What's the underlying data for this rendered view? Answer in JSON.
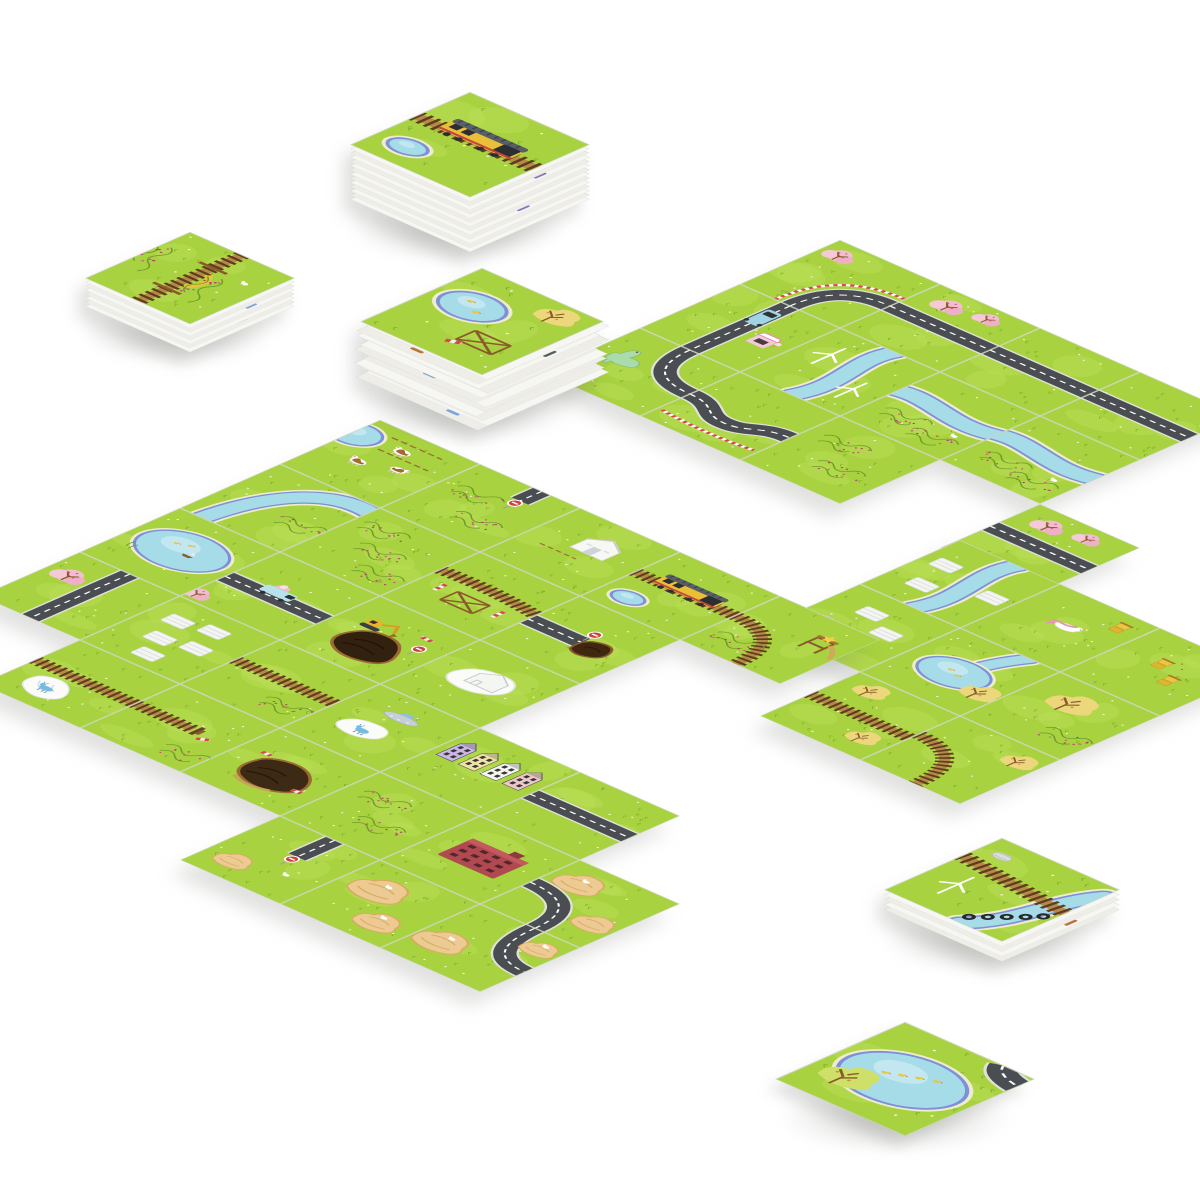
{
  "scene": {
    "background": "#ffffff",
    "description": "Photo-style overhead scene of an illustrated tile-laying board game: stacks of square landscape cards and three clusters of laid-out tiles connected by roads, railway tracks and rivers on a white table."
  },
  "palette": {
    "grass": "#a8d23f",
    "grass_light": "#b9dd55",
    "grass_dark": "#77aa28",
    "road": "#4a4e52",
    "road_edge": "#dfe3d5",
    "road_dash": "#ffffff",
    "water": "#a6dbe8",
    "water_deep": "#7e90d8",
    "shore": "#efeccb",
    "rail_tie": "#5f3d1b",
    "rail_wood": "#b5894a",
    "wood_dark": "#8a5a2b",
    "blossom": "#f2bdcf",
    "blossom_dot": "#d25d7e",
    "autumn": "#ecd77c",
    "canyon": "#ecca92",
    "canyon_line": "#d8ab63",
    "brick": "#b04a50",
    "train_yellow": "#e9bf37",
    "barrier_red": "#d84848",
    "card_side": "#f3f3ef",
    "card_edge": "#d8d8d2"
  },
  "geometry": {
    "tile_diamond_width": 200,
    "tile_diamond_height": 88,
    "col_step": {
      "x": 100,
      "y": 44
    },
    "row_step": {
      "x": -100,
      "y": 44
    }
  },
  "tile_types": {
    "grass_plain": "plain green meadow",
    "road_straight": "straight road with white dashes",
    "road_pink": "road with pink cherry-blossom trees",
    "road_curve_guard": "curved road with red-white guardrail and blossom tree",
    "road_s_guard": "S-shaped road with striped guardrail",
    "road_dino": "curved road with pale green dinosaur",
    "road_truck": "road with blue ice-cream truck",
    "roadend_tunnel": "dead-end road, no-entry sign and dark dirt mound",
    "roadend_dirt": "dead-end road with no-entry sign and goat",
    "canyon_road": "road curving between tan canyon mesas",
    "canyon_road2": "road bend through canyon rocks",
    "canyon_rocks": "tan mesa rocks with white goats",
    "rail_straight": "straight railway track",
    "rail_train": "railway with yellow diesel locomotive and pond",
    "rail_trees": "railway with yellow autumn trees",
    "rail_curve_r": "railway curving toward tile edge",
    "rail_waterfall": "railway beside white waterfall patch and blue alien cow",
    "rail_buffer": "railway ending at wooden buffer with striped barrier",
    "rail_bridge_berry": "vertical wooden rail bridge with yellow arch among berry fields",
    "rail_diag_river": "railway crossing with river, black tires and turbine outline",
    "trestle_rail": "railway on wooden trestle with red-white barriers",
    "river_meadow": "river bending through meadow",
    "river_windmill": "river with white wind turbines",
    "river_berry": "river beside wild berry scrub",
    "river_pond_tree": "river widening into pond with ducks and autumn tree",
    "pond_boats": "large pond with sailboat and ducks",
    "pond_trestle": "pond with ducks, autumn tree and construction trestle",
    "cows_pond": "pasture with three brown-white cows and pond corner",
    "berry_meadow": "meadow with berry-bush rows",
    "berry_hill": "hillside rows of berry bushes",
    "berries_roadend": "berry field with short dead-end road stub",
    "barn_grass": "white barn on meadow",
    "plots_white": "white planted garden beds",
    "plots_river": "garden beds split by a river",
    "plots_hay": "garden beds with grey hay rolls",
    "grass_shop": "roadside stop with small bus and ice-cream kiosk",
    "grass_unicorn": "white unicorn with pink mane resting on grass",
    "beehive_grass": "yellow beehive boxes on meadow",
    "yellowtree_berry": "large autumn tree with berry scrub",
    "city_houses": "row of pastel gabled townhouses",
    "red_factory": "red brick factory building with dark windows",
    "snow_house": "white snowy patch with outlined house",
    "snow_ufo": "hovering UFO above snow patch with blue alien cow",
    "excavator_hole": "yellow excavator digging a dark pit, striped cones",
    "dirt_pile": "large dark soil heap with striped markers",
    "slide_berry": "wooden lookout tower with slide and gold star beside curving rail",
    "lake_ducks_road": "wide lake with duck family, green tree and road corner"
  },
  "clusters": [
    {
      "name": "tile-cluster-top-right",
      "origin": {
        "x": 840,
        "y": 240
      },
      "tiles": [
        {
          "r": 0,
          "c": 0,
          "type": "road_curve_guard"
        },
        {
          "r": 0,
          "c": 1,
          "type": "road_pink"
        },
        {
          "r": 0,
          "c": 2,
          "type": "road_straight"
        },
        {
          "r": 0,
          "c": 3,
          "type": "road_straight"
        },
        {
          "r": 1,
          "c": 0,
          "type": "grass_shop"
        },
        {
          "r": 1,
          "c": 1,
          "type": "river_windmill"
        },
        {
          "r": 1,
          "c": 2,
          "type": "river_berry"
        },
        {
          "r": 1,
          "c": 3,
          "type": "river_berry"
        },
        {
          "r": 2,
          "c": 0,
          "type": "road_dino"
        },
        {
          "r": 2,
          "c": 1,
          "type": "road_s_guard"
        },
        {
          "r": 2,
          "c": 2,
          "type": "berry_meadow"
        },
        {
          "r": 2,
          "c": 4,
          "type": "road_pink"
        }
      ]
    },
    {
      "name": "tile-cluster-right-river",
      "origin": {
        "x": 960,
        "y": 540
      },
      "tiles": [
        {
          "r": 0,
          "c": 0,
          "type": "plots_river"
        },
        {
          "r": 0,
          "c": 1,
          "type": "grass_unicorn"
        },
        {
          "r": 0,
          "c": 2,
          "type": "beehive_grass"
        },
        {
          "r": 1,
          "c": 0,
          "type": "plots_hay"
        },
        {
          "r": 1,
          "c": 1,
          "type": "river_pond_tree"
        },
        {
          "r": 1,
          "c": 2,
          "type": "yellowtree_berry"
        },
        {
          "r": 2,
          "c": 1,
          "type": "rail_trees"
        },
        {
          "r": 2,
          "c": 2,
          "type": "rail_curve_r"
        }
      ]
    },
    {
      "name": "tile-cluster-central",
      "origin": {
        "x": 380,
        "y": 420
      },
      "tiles": [
        {
          "r": 0,
          "c": 0,
          "type": "cows_pond"
        },
        {
          "r": 0,
          "c": 1,
          "type": "berries_roadend"
        },
        {
          "r": 0,
          "c": 2,
          "type": "barn_grass"
        },
        {
          "r": 0,
          "c": 3,
          "type": "rail_train"
        },
        {
          "r": 0,
          "c": 4,
          "type": "slide_berry"
        },
        {
          "r": 1,
          "c": 0,
          "type": "river_meadow"
        },
        {
          "r": 1,
          "c": 1,
          "type": "berry_hill"
        },
        {
          "r": 1,
          "c": 2,
          "type": "trestle_rail"
        },
        {
          "r": 1,
          "c": 3,
          "type": "roadend_tunnel"
        },
        {
          "r": 2,
          "c": 0,
          "type": "pond_boats"
        },
        {
          "r": 2,
          "c": 1,
          "type": "road_truck"
        },
        {
          "r": 2,
          "c": 2,
          "type": "excavator_hole"
        },
        {
          "r": 2,
          "c": 3,
          "type": "snow_house"
        },
        {
          "r": 3,
          "c": 0,
          "type": "pink_road"
        },
        {
          "r": 3,
          "c": 1,
          "type": "plots_white"
        },
        {
          "r": 3,
          "c": 2,
          "type": "rail_straight"
        },
        {
          "r": 3,
          "c": 3,
          "type": "snow_ufo"
        },
        {
          "r": 3,
          "c": 4,
          "type": "city_houses"
        },
        {
          "r": 3,
          "c": 5,
          "type": "road_straight"
        },
        {
          "r": 4,
          "c": 1,
          "type": "rail_waterfall"
        },
        {
          "r": 4,
          "c": 2,
          "type": "rail_buffer"
        },
        {
          "r": 4,
          "c": 3,
          "type": "dirt_pile"
        },
        {
          "r": 4,
          "c": 4,
          "type": "berry_meadow"
        },
        {
          "r": 4,
          "c": 5,
          "type": "red_factory"
        },
        {
          "r": 4,
          "c": 6,
          "type": "canyon_road"
        },
        {
          "r": 5,
          "c": 4,
          "type": "roadend_dirt"
        },
        {
          "r": 5,
          "c": 5,
          "type": "canyon_rocks"
        },
        {
          "r": 5,
          "c": 6,
          "type": "canyon_road2"
        }
      ]
    }
  ],
  "stacks": [
    {
      "name": "stack-draw-pile-top",
      "x": 470,
      "y": 92,
      "layers": 14,
      "layer_offset": 4.2,
      "scale": 1.2,
      "fanned": false,
      "top": "rail_train"
    },
    {
      "name": "stack-flat-left",
      "x": 190,
      "y": 232,
      "layers": 8,
      "layer_offset": 4.0,
      "scale": 1.05,
      "fanned": false,
      "top": "rail_bridge_berry"
    },
    {
      "name": "stack-fanned-middle",
      "x": 482,
      "y": 268,
      "layers": 13,
      "layer_offset": 4.6,
      "scale": 1.22,
      "fanned": true,
      "top": "pond_trestle"
    },
    {
      "name": "stack-small-bottom-right",
      "x": 1002,
      "y": 838,
      "layers": 5,
      "layer_offset": 5.0,
      "scale": 1.18,
      "fanned": false,
      "top": "rail_diag_river"
    }
  ],
  "loose_tiles": [
    {
      "name": "loose-tile-lake",
      "x": 905,
      "y": 1022,
      "scale": 1.3,
      "type": "lake_ducks_road"
    }
  ]
}
